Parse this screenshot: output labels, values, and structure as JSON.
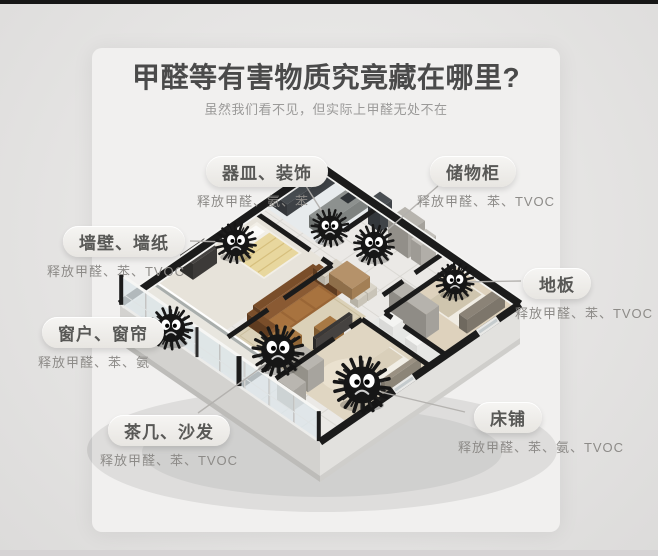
{
  "header": {
    "title": "甲醛等有害物质究竟藏在哪里?",
    "subtitle": "虽然我们看不见，但实际上甲醛无处不在"
  },
  "labels": [
    {
      "name": "器皿、装饰",
      "release": "释放甲醛、氨、苯"
    },
    {
      "name": "储物柜",
      "release": "释放甲醛、苯、TVOC"
    },
    {
      "name": "墙壁、墙纸",
      "release": "释放甲醛、苯、TVOC"
    },
    {
      "name": "地板",
      "release": "释放甲醛、苯、TVOC"
    },
    {
      "name": "窗户、窗帘",
      "release": "释放甲醛、苯、氨"
    },
    {
      "name": "茶几、沙发",
      "release": "释放甲醛、苯、TVOC"
    },
    {
      "name": "床铺",
      "release": "释放甲醛、苯、氨、TVOC"
    }
  ],
  "icons": {
    "germ_monster": "fuzzy-black-germ-with-eyes"
  },
  "colors": {
    "background": "#e5e4e3",
    "card": "#f1f0ef",
    "title_text": "#4a4a4a",
    "subtitle_text": "#9b9a99",
    "pill_text": "#585856",
    "release_text": "#8d8b88",
    "leader_line": "#b3b1ae",
    "wall_black": "#1b1b1b",
    "floor": "#ebe9e6",
    "rug_beige": "#dbd1b8",
    "wood_floor": "#ded2bd",
    "sofa_brown": "#9a6636",
    "monster_body": "#161616",
    "monster_eye": "#ffffff",
    "glass": "#dde6ea"
  }
}
